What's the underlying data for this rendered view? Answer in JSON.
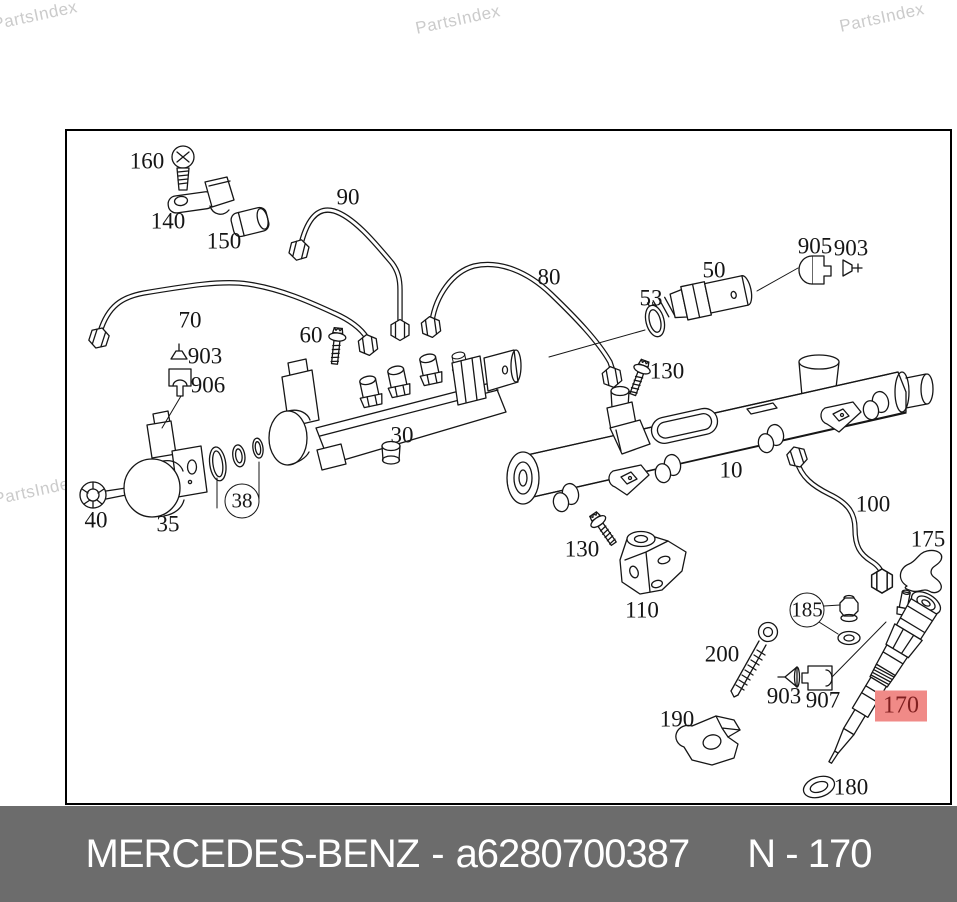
{
  "watermark": {
    "text": "PartsIndex",
    "color": "#cbcbcb",
    "rotation_deg": -12,
    "positions": [
      {
        "x": 35,
        "y": 16
      },
      {
        "x": 458,
        "y": 20
      },
      {
        "x": 882,
        "y": 18
      },
      {
        "x": 36,
        "y": 491
      },
      {
        "x": 456,
        "y": 497
      },
      {
        "x": 881,
        "y": 492
      }
    ]
  },
  "diagram": {
    "border_color": "#000000",
    "highlight": {
      "bg": "#f08a87",
      "text_color": "#801f1f"
    },
    "labels": [
      {
        "text": "160",
        "x": 147,
        "y": 161,
        "style": "plain"
      },
      {
        "text": "140",
        "x": 168,
        "y": 221,
        "style": "plain"
      },
      {
        "text": "150",
        "x": 224,
        "y": 241,
        "style": "plain"
      },
      {
        "text": "90",
        "x": 348,
        "y": 197,
        "style": "plain"
      },
      {
        "text": "80",
        "x": 549,
        "y": 277,
        "style": "plain"
      },
      {
        "text": "70",
        "x": 190,
        "y": 320,
        "style": "plain"
      },
      {
        "text": "60",
        "x": 311,
        "y": 335,
        "style": "plain"
      },
      {
        "text": "50",
        "x": 714,
        "y": 270,
        "style": "plain"
      },
      {
        "text": "53",
        "x": 651,
        "y": 298,
        "style": "plain"
      },
      {
        "text": "905",
        "x": 815,
        "y": 246,
        "style": "plain"
      },
      {
        "text": "903",
        "x": 851,
        "y": 248,
        "style": "plain"
      },
      {
        "text": "130",
        "x": 667,
        "y": 371,
        "style": "plain"
      },
      {
        "text": "903",
        "x": 205,
        "y": 356,
        "style": "plain"
      },
      {
        "text": "906",
        "x": 208,
        "y": 385,
        "style": "plain"
      },
      {
        "text": "30",
        "x": 402,
        "y": 435,
        "style": "plain"
      },
      {
        "text": "10",
        "x": 731,
        "y": 470,
        "style": "plain"
      },
      {
        "text": "38",
        "x": 242,
        "y": 501,
        "style": "circled"
      },
      {
        "text": "40",
        "x": 96,
        "y": 520,
        "style": "plain"
      },
      {
        "text": "35",
        "x": 168,
        "y": 524,
        "style": "plain"
      },
      {
        "text": "100",
        "x": 873,
        "y": 504,
        "style": "plain"
      },
      {
        "text": "175",
        "x": 928,
        "y": 539,
        "style": "plain"
      },
      {
        "text": "130",
        "x": 582,
        "y": 549,
        "style": "plain"
      },
      {
        "text": "110",
        "x": 642,
        "y": 610,
        "style": "plain"
      },
      {
        "text": "185",
        "x": 807,
        "y": 610,
        "style": "circled"
      },
      {
        "text": "200",
        "x": 722,
        "y": 654,
        "style": "plain"
      },
      {
        "text": "190",
        "x": 677,
        "y": 719,
        "style": "plain"
      },
      {
        "text": "903",
        "x": 784,
        "y": 696,
        "style": "plain"
      },
      {
        "text": "907",
        "x": 823,
        "y": 700,
        "style": "plain"
      },
      {
        "text": "170",
        "x": 901,
        "y": 706,
        "style": "highlighted"
      },
      {
        "text": "180",
        "x": 851,
        "y": 787,
        "style": "plain"
      }
    ]
  },
  "footer": {
    "bg": "#6c6c6c",
    "text_color": "#ffffff",
    "brand": "MERCEDES-BENZ",
    "separator": "-",
    "part_number": "a6280700387",
    "page_ref": "N - 170"
  }
}
